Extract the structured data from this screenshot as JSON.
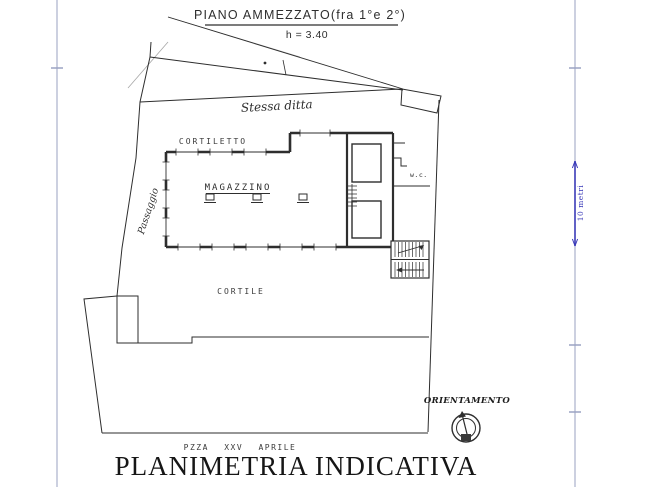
{
  "title": {
    "text": "PIANO AMMEZZATO(fra 1°e 2°)",
    "height_note": "h = 3.40"
  },
  "plan": {
    "rooms": {
      "stessa_ditta": "Stessa ditta",
      "cortiletto": "CORTILETTO",
      "magazzino": "MAGAZZINO",
      "passaggio": "Passaggio",
      "cortile": "CORTILE",
      "wc": "w.c."
    },
    "street": "PZZA  XXV  APRILE"
  },
  "scale_bar": {
    "label": "10 metri"
  },
  "compass": {
    "label": "ORIENTAMENTO"
  },
  "caption": "PLANIMETRIA INDICATIVA",
  "colors": {
    "ink": "#2e2e2e",
    "frame_line": "#9aa2c2",
    "scale_blue": "#3a3ab8",
    "paper": "#ffffff"
  }
}
